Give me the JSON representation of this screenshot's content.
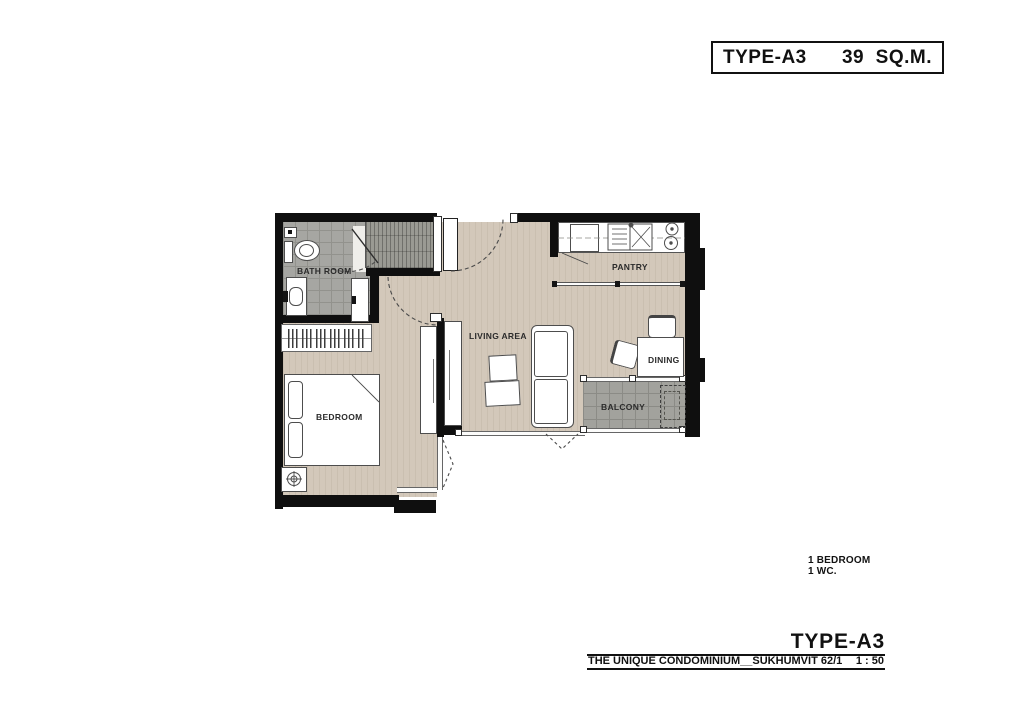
{
  "header": {
    "type": "TYPE-A3",
    "area": "39  SQ.M."
  },
  "plan": {
    "rooms": [
      {
        "id": "bathroom",
        "label": "BATH ROOM"
      },
      {
        "id": "pantry",
        "label": "PANTRY"
      },
      {
        "id": "living_area",
        "label": "LIVING AREA"
      },
      {
        "id": "dining",
        "label": "DINING"
      },
      {
        "id": "balcony",
        "label": "BALCONY"
      },
      {
        "id": "bedroom",
        "label": "BEDROOM"
      }
    ],
    "colors": {
      "wall": "#0f0f0f",
      "wood_floor": "#d3c8ba",
      "bath_tile": "#a6a6a2",
      "balcony_tile": "#a2a29d",
      "hatch_tile": "#9a9a93"
    }
  },
  "summary": {
    "bedrooms": "1 BEDROOM",
    "wc": "1 WC."
  },
  "titleblock": {
    "type": "TYPE-A3",
    "project": "THE UNIQUE CONDOMINIUM__SUKHUMVIT 62/1",
    "scale": "1 : 50"
  }
}
